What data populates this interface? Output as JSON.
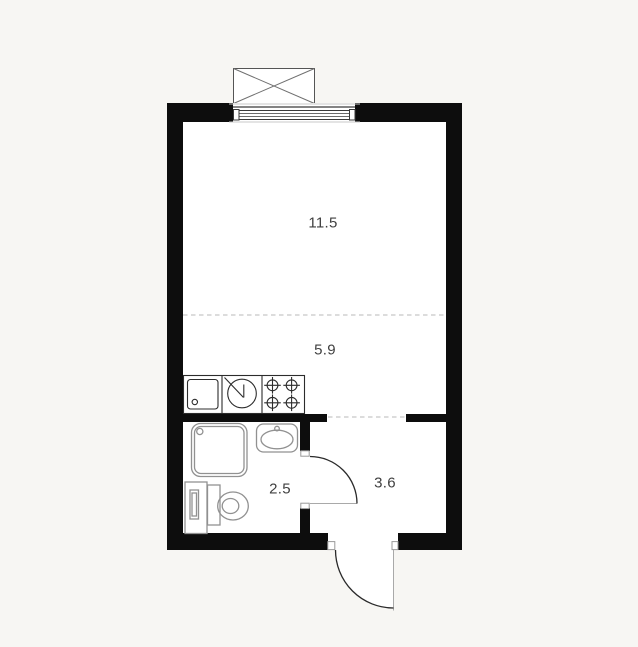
{
  "plan": {
    "background_color": "#f7f6f3",
    "floor_color": "#ffffff",
    "wall_color": "#0d0d0d",
    "window_line_color": "#3a3a3a",
    "sill_line_color": "#c8c8c8",
    "zone_dash_color": "#d0d0d0",
    "kitchen_line_color": "#2c2c2c",
    "fixture_line_color": "#919191",
    "door_arc_color": "#2a2a2a",
    "door_leaf_color": "#a9a9a9",
    "balcony_line_color": "#6f6f6f",
    "label_color": "#3f3f3f"
  },
  "rooms": [
    {
      "name": "living-area",
      "area": "11.5"
    },
    {
      "name": "kitchen-zone",
      "area": "5.9"
    },
    {
      "name": "bathroom",
      "area": "2.5"
    },
    {
      "name": "hallway",
      "area": "3.6"
    }
  ],
  "icons": [
    "balcony-icon",
    "window-icon",
    "kitchen-sink-icon",
    "washing-machine-icon",
    "stove-icon",
    "shower-icon",
    "washbasin-icon",
    "toilet-icon",
    "boiler-icon",
    "door-swing-icon",
    "entrance-door-swing-icon"
  ]
}
